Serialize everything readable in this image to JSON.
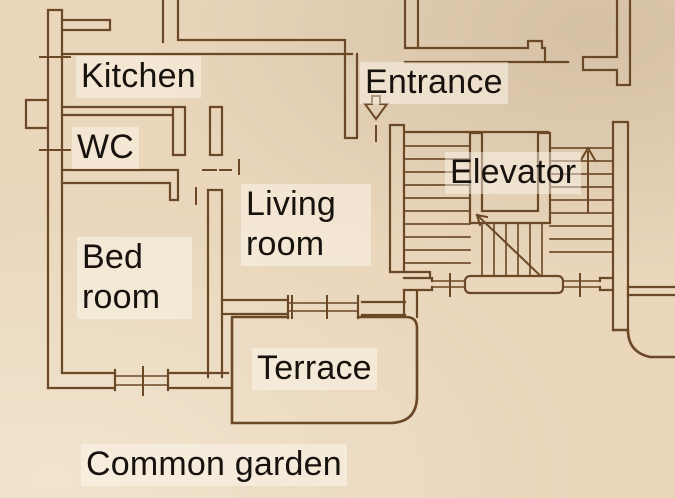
{
  "plan": {
    "type": "apartment-floor-plan",
    "labels": {
      "kitchen": "Kitchen",
      "wc": "WC",
      "entrance": "Entrance",
      "elevator": "Elevator",
      "living_room": "Living room",
      "bedroom": "Bed room",
      "terrace": "Terrace",
      "common_garden": "Common garden"
    },
    "icons": {
      "entrance_arrow": "down-arrow",
      "stairs_up_arrow": "up-arrow",
      "stairs_direction": "diagonal-run-line"
    },
    "colors": {
      "paper": "#e9d6bb",
      "wall_line": "#6b4826",
      "label_text": "#17120e",
      "label_chip": "rgba(255,250,242,0.45)"
    }
  }
}
